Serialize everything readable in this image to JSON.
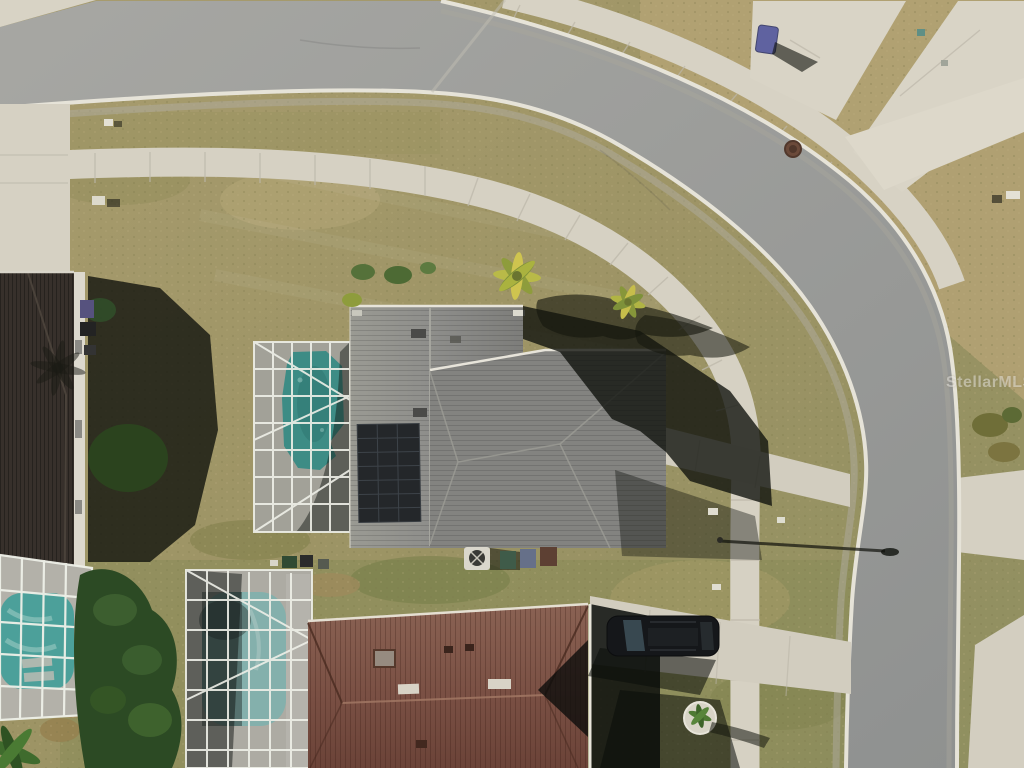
{
  "watermark": {
    "text": "StellarMLS"
  },
  "scene": {
    "type": "aerial-drone-photograph",
    "description": "Top-down aerial photo of a suburban corner lot: a curved asphalt street wraps a dry lawn; the center home has a gray shingle roof with rooftop solar panels and a screened pool enclosure with a teal pool; a brown-roof home below has its own screened pool and a dark SUV in the driveway; a dark-roof home sits at the left edge with a third screened pool; palm trees, sidewalks, driveways, a manhole, trash bins and a streetlight shadow are visible.",
    "objects": [
      "curved-asphalt-street",
      "outer-sidewalk",
      "inner-sidewalk",
      "center-house-gray-roof",
      "solar-panel-array",
      "center-pool-enclosure",
      "center-pool",
      "center-driveway",
      "bottom-house-brown-roof",
      "bottom-pool-enclosure",
      "bottom-pool",
      "bottom-driveway",
      "parked-suv",
      "left-house-dark-roof",
      "left-driveway",
      "left-pool-enclosure",
      "left-pool",
      "hedge-trees",
      "palm-trees",
      "palm-shadows",
      "streetlight-shadow",
      "manhole-cover",
      "curbside-trash-bin",
      "utility-markers",
      "ac-unit",
      "young-palm-in-rock-ring"
    ],
    "palette": {
      "road": "#9a9a97",
      "curb": "#e6e3d8",
      "concrete": "#d7d2c4",
      "grass_dry": "#ad9f6e",
      "grass_olive": "#8f8f5e",
      "roof_center": "#8d8d8b",
      "roof_bottom": "#7c5144",
      "roof_left": "#332c26",
      "pool_teal": "#2d9a94",
      "pool_light": "#8ec9c4",
      "solar_panel": "#25282b",
      "shadow": "rgba(14,17,12,0.8)",
      "tree_green": "#2f4a26",
      "car": "#17191c",
      "trash_bin_blue": "#5f62a0"
    }
  }
}
